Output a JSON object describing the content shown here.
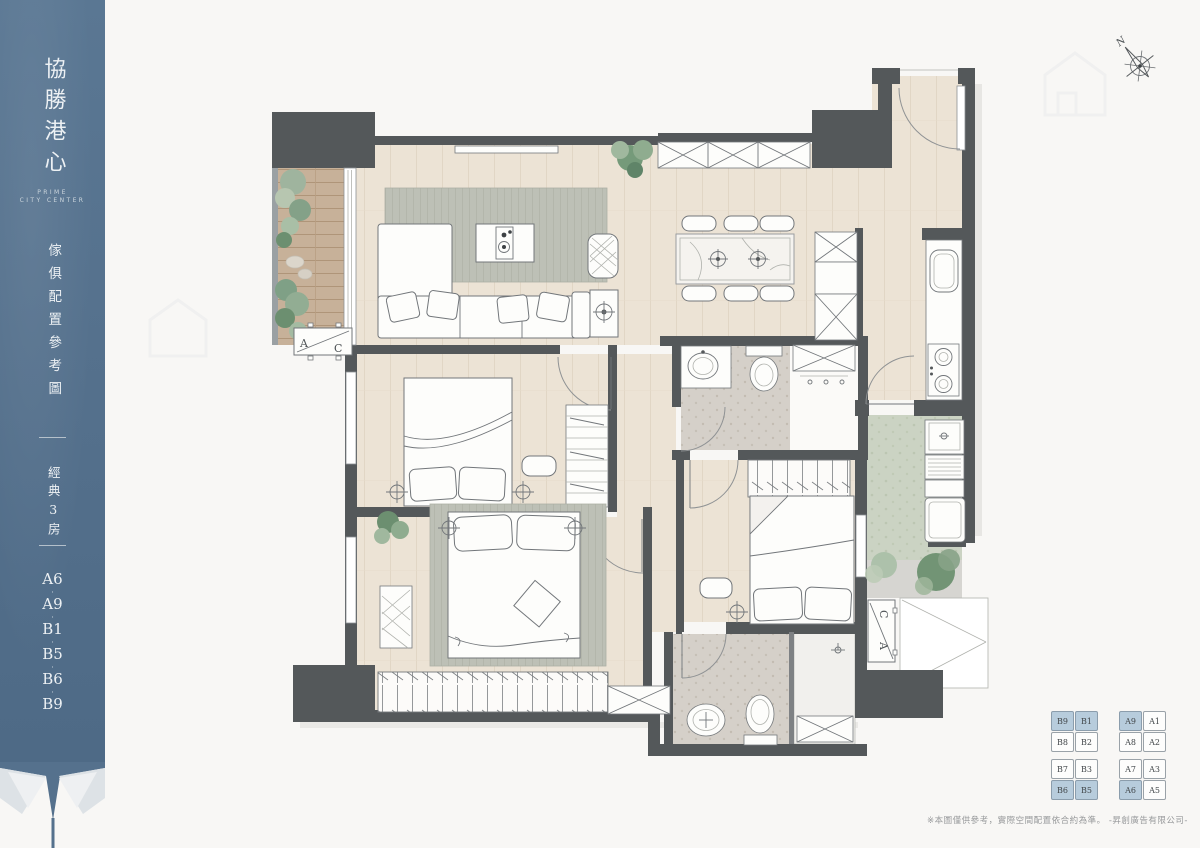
{
  "colors": {
    "sidebar_bg": "#55718d",
    "wall": "#54585a",
    "keyplan_highlight": "#b7ccdc",
    "wood_floor": "#ece3d5",
    "balcony_deck": "#c7b199"
  },
  "sidebar": {
    "brand": "協勝港心",
    "brand_en_1": "PRIME",
    "brand_en_2": "CITY CENTER",
    "caption": "傢俱配置參考圖",
    "category": "經典3房",
    "units_display": [
      "A6",
      "·",
      "A9",
      "·",
      "B1",
      "·",
      "B5",
      "·",
      "B6",
      "·",
      "B9"
    ]
  },
  "plan": {
    "compass_label": "N",
    "ac_label_a": "A",
    "ac_label_c": "C"
  },
  "keyplan": {
    "b_block": [
      [
        "B9",
        "B1"
      ],
      [
        "B8",
        "B2"
      ],
      [
        "B7",
        "B3"
      ],
      [
        "B6",
        "B5"
      ]
    ],
    "a_block": [
      [
        "A9",
        "A1"
      ],
      [
        "A8",
        "A2"
      ],
      [
        "A7",
        "A3"
      ],
      [
        "A6",
        "A5"
      ]
    ],
    "highlighted": [
      "B9",
      "B1",
      "B6",
      "B5",
      "A9",
      "A6"
    ]
  },
  "footer": {
    "disclaimer": "※本圖僅供參考，實際空間配置依合約為準。 -昇創廣告有限公司-"
  }
}
